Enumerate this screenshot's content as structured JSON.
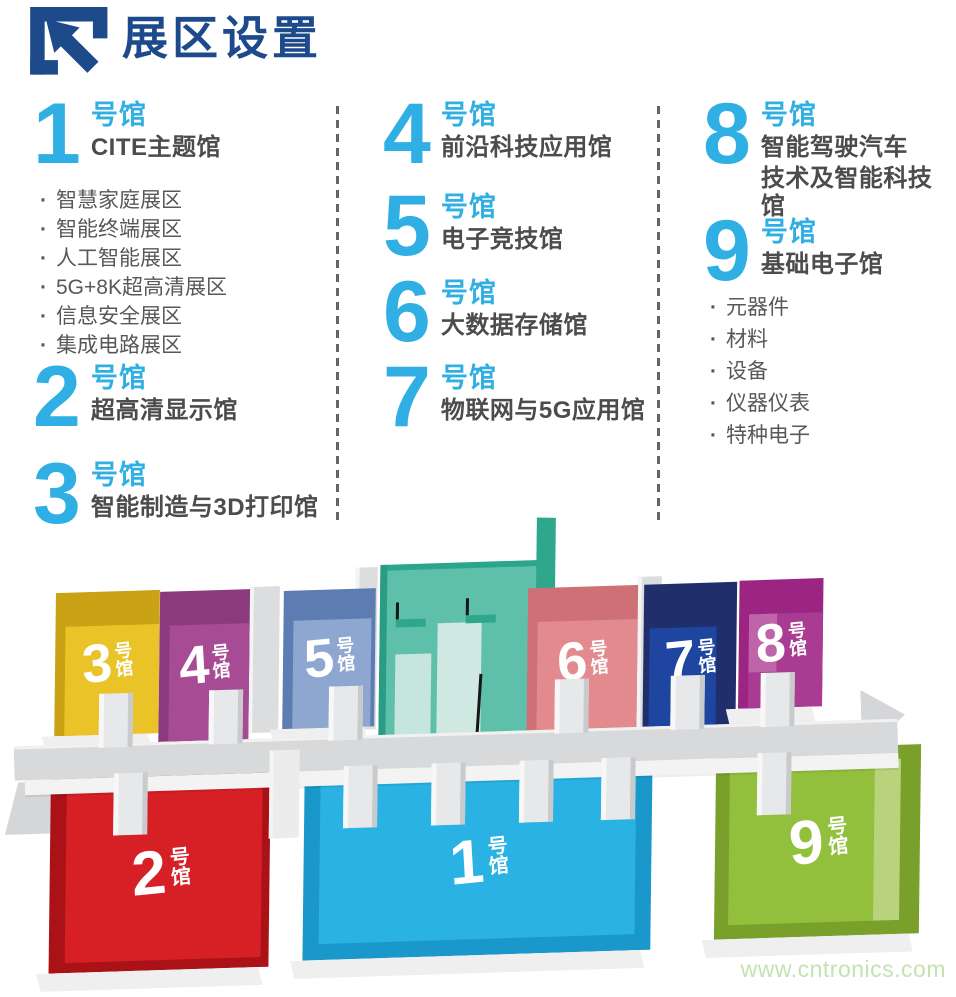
{
  "header": {
    "title": "展区设置",
    "logo": "corner-bracket-arrow-logo"
  },
  "colors": {
    "title_blue": "#1c4a8b",
    "accent_blue": "#2fafe3",
    "name_gray": "#4c4c4e",
    "text_gray": "#58585a",
    "divider_gray": "#656567",
    "watermark_green": "#c3e3af"
  },
  "sections": [
    {
      "number": "1",
      "suffix": "号馆",
      "name": "CITE主题馆",
      "items": [
        "智慧家庭展区",
        "智能终端展区",
        "人工智能展区",
        "5G+8K超高清展区",
        "信息安全展区",
        "集成电路展区"
      ]
    },
    {
      "number": "2",
      "suffix": "号馆",
      "name": "超高清显示馆"
    },
    {
      "number": "3",
      "suffix": "号馆",
      "name": "智能制造与3D打印馆"
    },
    {
      "number": "4",
      "suffix": "号馆",
      "name": "前沿科技应用馆"
    },
    {
      "number": "5",
      "suffix": "号馆",
      "name": "电子竞技馆"
    },
    {
      "number": "6",
      "suffix": "号馆",
      "name": "大数据存储馆"
    },
    {
      "number": "7",
      "suffix": "号馆",
      "name": "物联网与5G应用馆"
    },
    {
      "number": "8",
      "suffix": "号馆",
      "name": "智能驾驶汽车",
      "name2": "技术及智能科技馆"
    },
    {
      "number": "9",
      "suffix": "号馆",
      "name": "基础电子馆",
      "items": [
        "元器件",
        "材料",
        "设备",
        "仪器仪表",
        "特种电子"
      ]
    }
  ],
  "map": {
    "halls": {
      "h1": {
        "number": "1",
        "suffix": "号馆",
        "rim": "#1a97cb",
        "floor": "#29b2e3"
      },
      "h2": {
        "number": "2",
        "suffix": "号馆",
        "rim": "#aa1217",
        "floor": "#d62026"
      },
      "h3": {
        "number": "3",
        "suffix": "号馆",
        "rim": "#c9a216",
        "floor": "#e9c327"
      },
      "h4": {
        "number": "4",
        "suffix": "号馆",
        "rim": "#8c3a7e",
        "floor": "#a84b95"
      },
      "h5": {
        "number": "5",
        "suffix": "号馆",
        "rim": "#5d7cb2",
        "floor": "#8ea7d1"
      },
      "h6": {
        "number": "6",
        "suffix": "号馆",
        "rim": "#ce7075",
        "floor": "#e28a8e"
      },
      "h7": {
        "number": "7",
        "suffix": "号馆",
        "rim": "#202e6b",
        "floor": "#1e46a0"
      },
      "h8": {
        "number": "8",
        "suffix": "号馆",
        "rim": "#9c2482",
        "floor": "#a93c92"
      },
      "h9": {
        "number": "9",
        "suffix": "号馆",
        "rim": "#79a02a",
        "floor": "#93c03c"
      },
      "center": {
        "number": "",
        "suffix": "",
        "rim": "#2ba68c",
        "floor": "#5ec0aa"
      }
    }
  },
  "watermark": "www.cntronics.com"
}
